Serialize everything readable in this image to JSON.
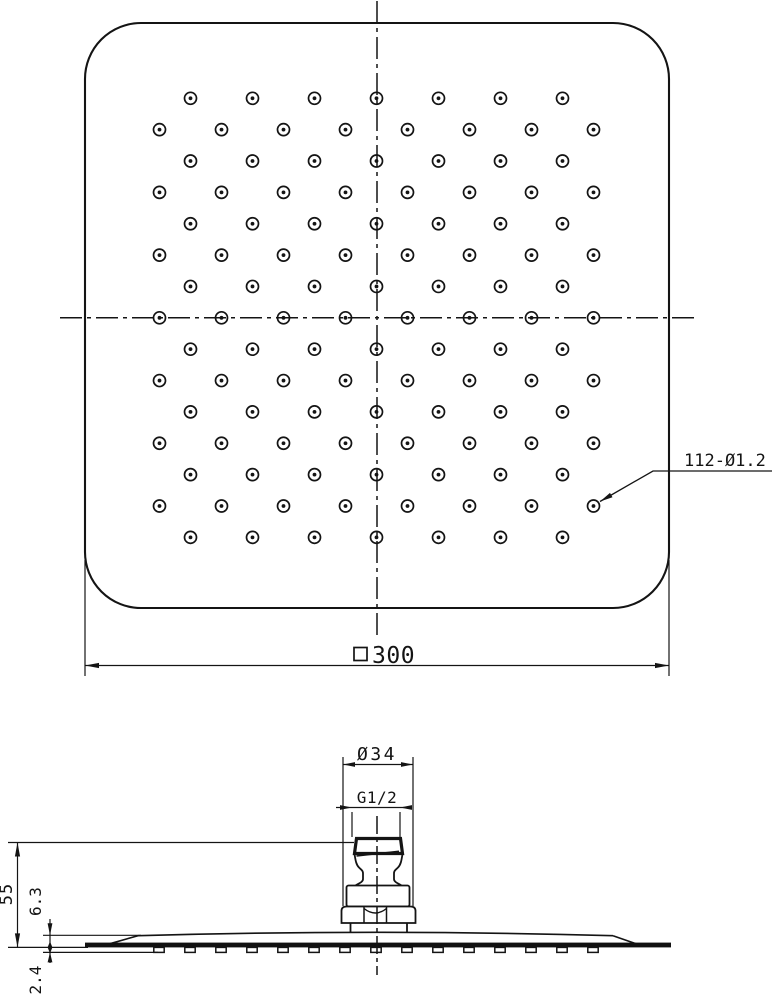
{
  "drawing": {
    "type": "technical-drawing",
    "subject": "square rain shower head, top view and side elevation"
  },
  "labels": {
    "size_symbol": "□",
    "size_value": "300",
    "holes_callout": "112-Ø1.2",
    "connector_diameter": "Ø34",
    "thread_spec": "G1/2",
    "overall_height": "55",
    "face_height": "6.3",
    "nozzle_height": "2.4"
  },
  "top_view": {
    "outline": {
      "x": 85,
      "y": 23,
      "width": 584,
      "height": 585,
      "corner_radius": 56
    },
    "holes": {
      "total": 112,
      "rows": 15,
      "first_row_y": 98.3,
      "row_pitch": 31.36,
      "center_x": 376.5,
      "col_pitch": 62,
      "cols_odd_rows": 7,
      "cols_even_rows": 8,
      "outer_r": 6.0,
      "dot_r": 1.9
    }
  },
  "side_view": {
    "nozzle_nubs": {
      "count": 15,
      "start_x": 159,
      "pitch": 31,
      "width": 10.4,
      "top_y": 947.4,
      "height": 5
    }
  },
  "colors": {
    "line": "#141414",
    "fill_black": "#111111",
    "background": "#ffffff"
  }
}
